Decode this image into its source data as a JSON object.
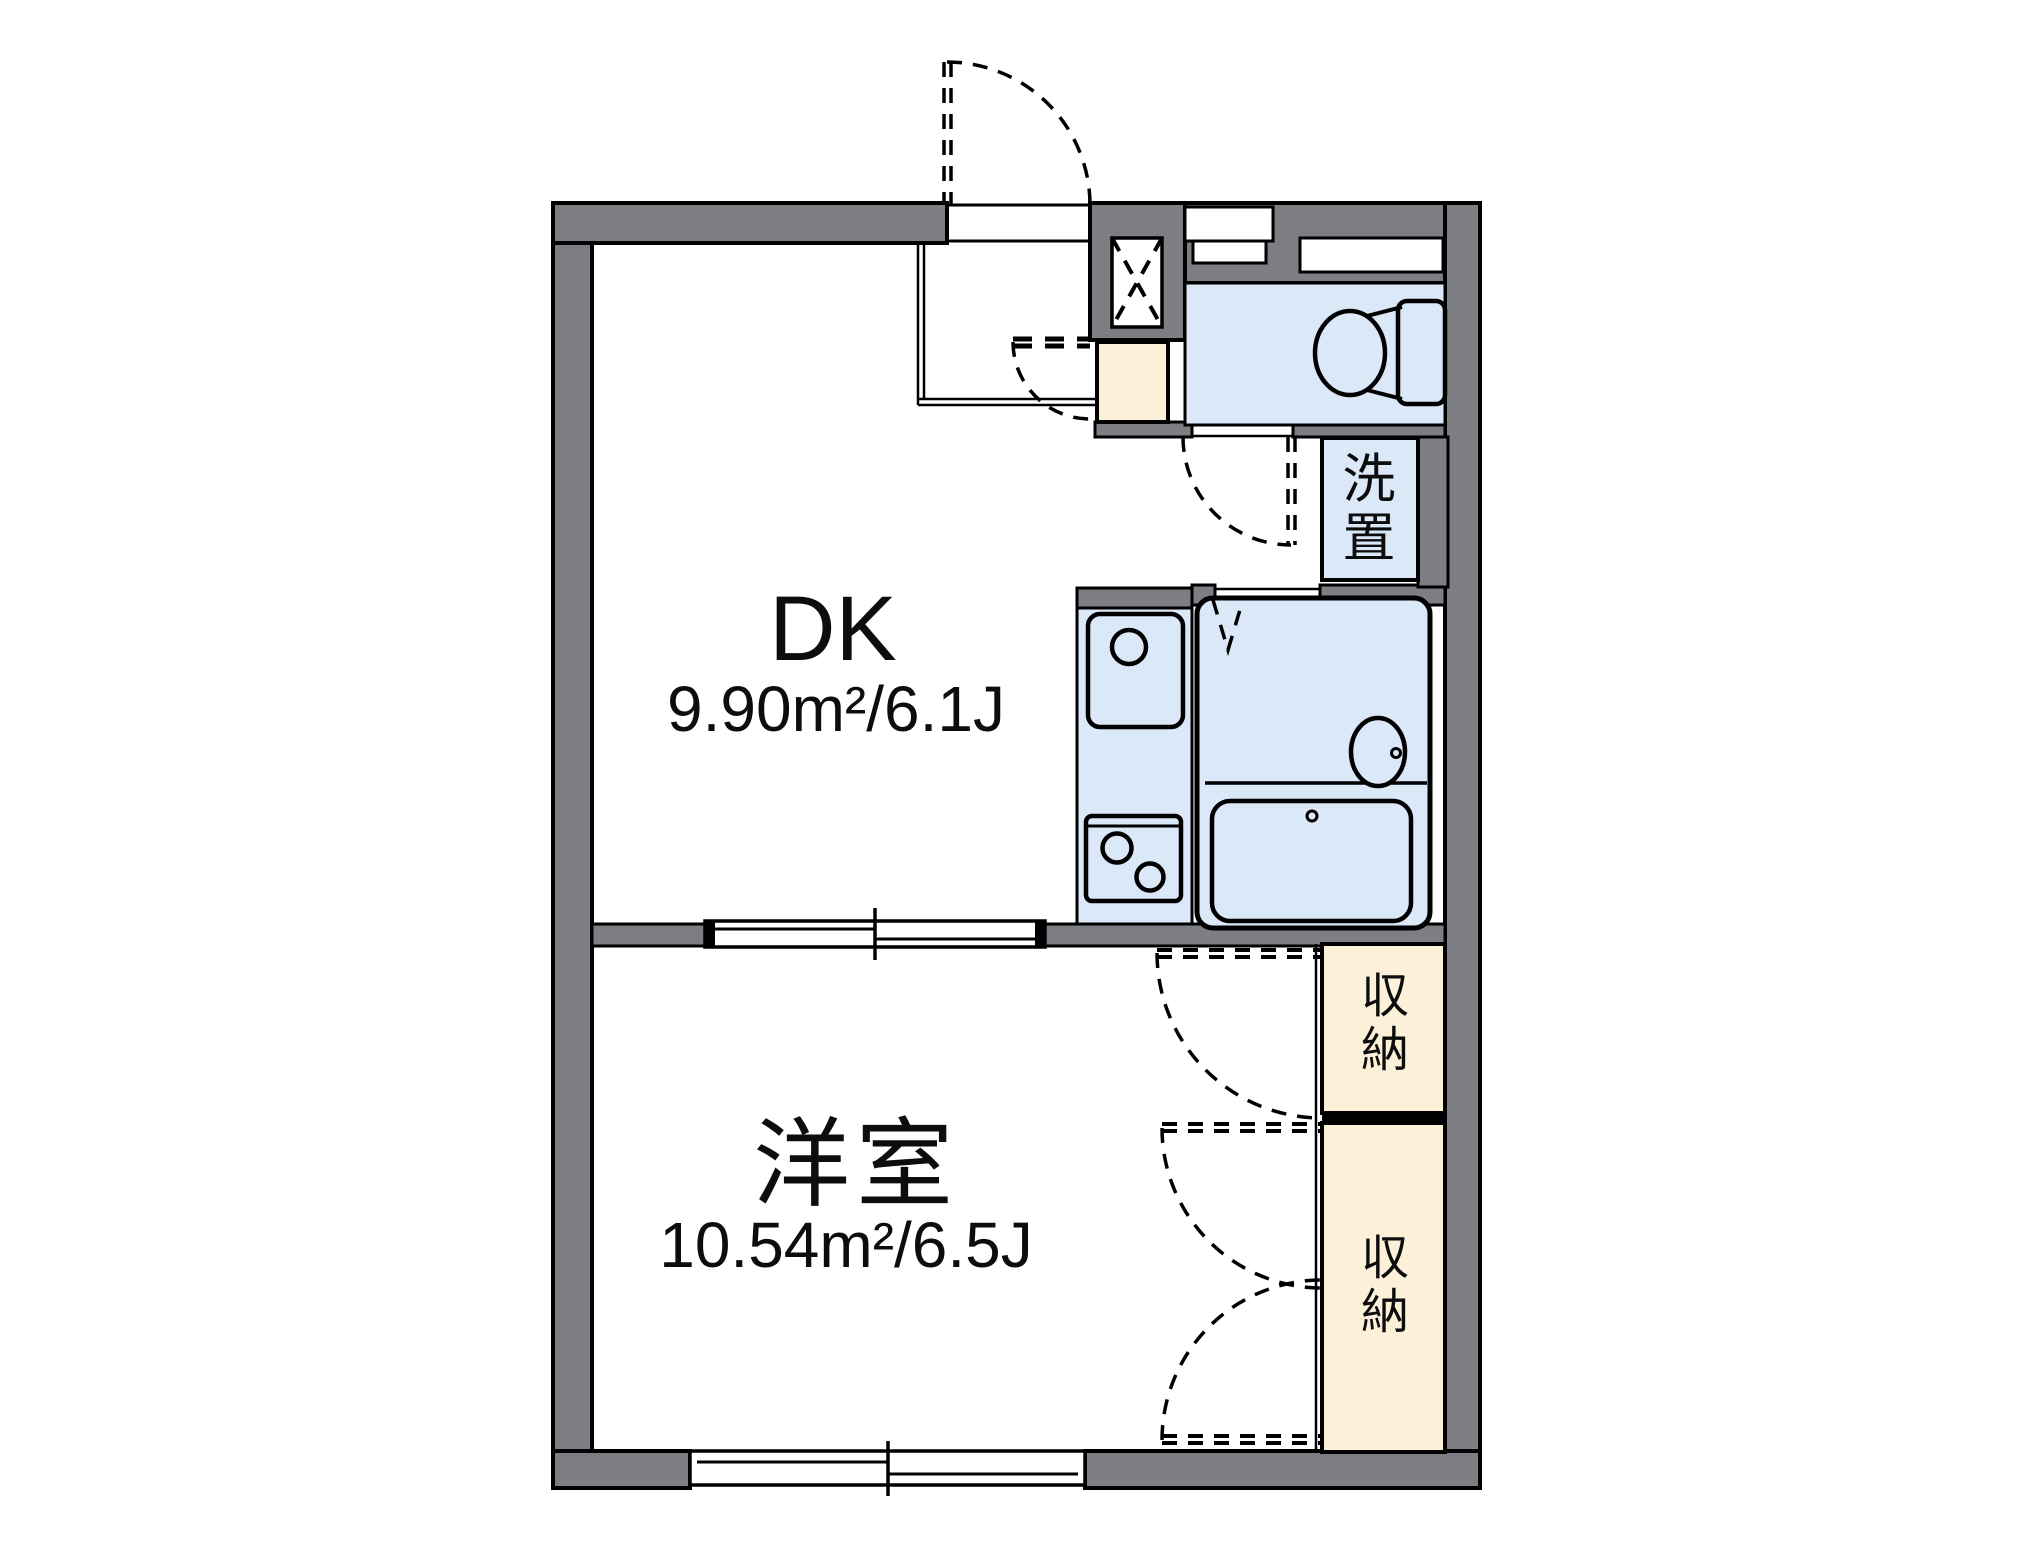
{
  "rooms": {
    "dk": {
      "name": "DK",
      "area": "9.90m²/6.1J"
    },
    "youshitsu": {
      "name": "洋室",
      "area": "10.54m²/6.5J"
    },
    "laundry": {
      "name": "洗置",
      "chars": [
        "洗",
        "置"
      ]
    },
    "closet_upper": {
      "name": "収納",
      "chars": [
        "収",
        "納"
      ]
    },
    "closet_lower": {
      "name": "収納",
      "chars": [
        "収",
        "納"
      ]
    }
  },
  "colors": {
    "wall": "#7d7d84",
    "water": "#dbe8f8",
    "storage": "#fcf0d8",
    "line": "#000000",
    "bg": "#ffffff"
  }
}
